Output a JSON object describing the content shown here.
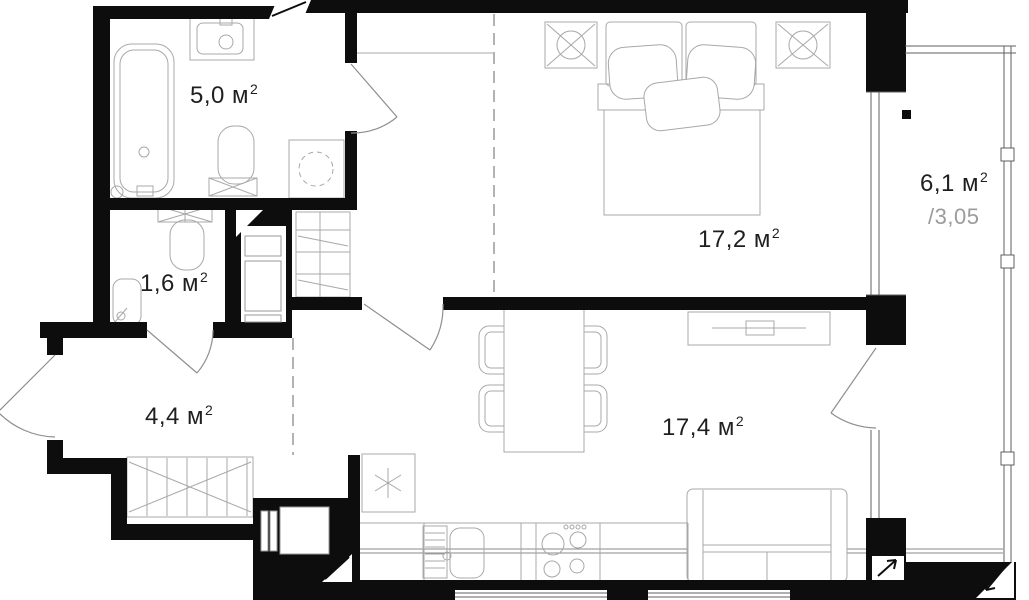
{
  "plan": {
    "title": "apartment-floor-plan",
    "rooms": [
      {
        "id": "bathroom",
        "area": "5,0 м",
        "sup": "2"
      },
      {
        "id": "wc",
        "area": "1,6 м",
        "sup": "2"
      },
      {
        "id": "hallway",
        "area": "4,4 м",
        "sup": "2"
      },
      {
        "id": "bedroom",
        "area": "17,2 м",
        "sup": "2"
      },
      {
        "id": "living-kitchen",
        "area": "17,4 м",
        "sup": "2"
      },
      {
        "id": "balcony",
        "area": "6,1 м",
        "sup": "2",
        "coefficient": "/3,05"
      }
    ],
    "colors": {
      "wall": "#0d0d0d",
      "furniture_line": "#a8a8a8",
      "window_line": "#5f5f5f",
      "door_line": "#8f8f8f",
      "dashed_line": "#9a9a9a",
      "label": "#1f1f1f",
      "muted_label": "#9b9b9b",
      "background": "#ffffff"
    },
    "symbols": {
      "fridge": "snowflake-icon",
      "bedside-table": "circled-cross-icon",
      "washing-machine": "dashed-drum-circle-icon",
      "wall-break": "diagonal-cut-icon",
      "balcony-direction": "diagonal-arrow-icon"
    }
  }
}
